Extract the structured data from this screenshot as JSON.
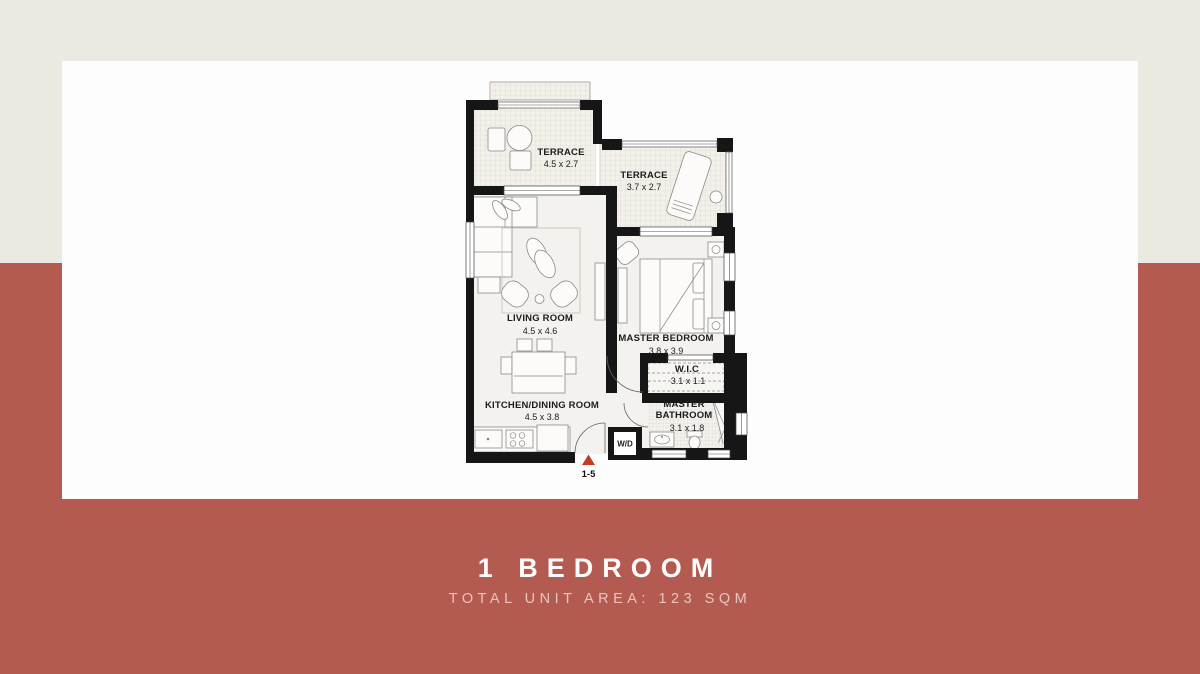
{
  "caption": {
    "title": "1 BEDROOM",
    "subtitle": "TOTAL UNIT AREA: 123 SQM"
  },
  "colors": {
    "band_top": "#ebeae2",
    "band_bottom": "#b45b51",
    "panel": "#fdfdfd",
    "wall": "#161616",
    "entry_marker_red": "#c23b28"
  },
  "plan": {
    "rooms": {
      "terrace_1": {
        "name": "TERRACE",
        "dims": "4.5 x 2.7"
      },
      "terrace_2": {
        "name": "TERRACE",
        "dims": "3.7 x 2.7"
      },
      "living_room": {
        "name": "LIVING ROOM",
        "dims": "4.5 x 4.6"
      },
      "master_bedroom": {
        "name": "MASTER BEDROOM",
        "dims": "3.8 x 3.9"
      },
      "wic": {
        "name": "W.I.C",
        "dims": "3.1 x 1.1"
      },
      "kitchen_dining": {
        "name": "KITCHEN/DINING ROOM",
        "dims": "4.5 x 3.8"
      },
      "master_bathroom": {
        "name_line_1": "MASTER",
        "name_line_2": "BATHROOM",
        "dims": "3.1 x 1.8"
      }
    },
    "utility": {
      "label": "W/D"
    },
    "entry": {
      "label": "1-5"
    }
  }
}
